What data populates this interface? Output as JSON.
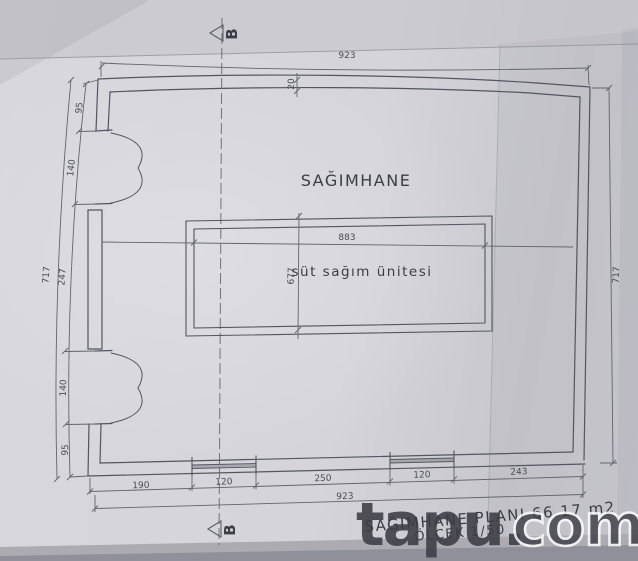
{
  "scan": {
    "room_label": "SAĞIMHANE",
    "unit_label": "süt sağım ünitesi",
    "title_line": "SAĞIMHANE PLANI 66.17 m2",
    "scale_line": "ÖLÇEK 1/50",
    "section_letter": "B"
  },
  "dimensions": {
    "top_width": "923",
    "bottom_width": "923",
    "left_total": "717",
    "right_total": "717",
    "wall_thickness": "20",
    "unit_width": "883",
    "unit_depth": "677",
    "left_segments": [
      "95",
      "140",
      "247",
      "140",
      "95"
    ],
    "bottom_segments": [
      "190",
      "120",
      "250",
      "120",
      "243"
    ]
  },
  "watermark": {
    "solid": "tapu.",
    "outline": "com"
  },
  "colors": {
    "ink": "#5a5a63",
    "dim_ink": "#64646d",
    "paper": "#d3d3d9",
    "text_dark": "#3c3c45",
    "watermark": "#ffffff"
  }
}
